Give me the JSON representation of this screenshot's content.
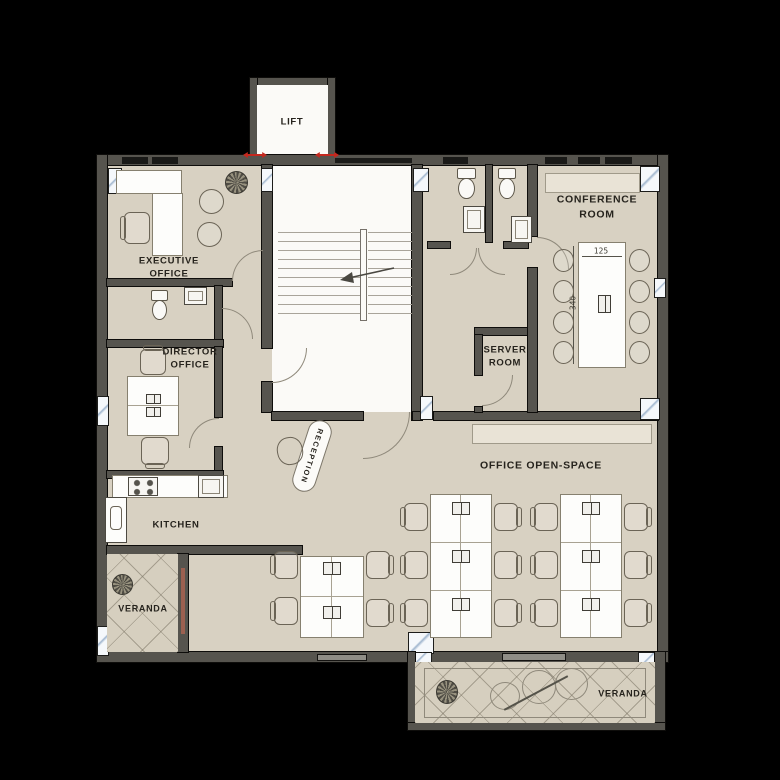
{
  "plan": {
    "rooms": {
      "lift": {
        "label": "LIFT"
      },
      "executive_office": {
        "label": "EXECUTIVE\nOFFICE"
      },
      "director_office": {
        "label": "DIRECTOR\nOFFICE"
      },
      "kitchen": {
        "label": "KITCHEN"
      },
      "veranda_left": {
        "label": "VERANDA"
      },
      "reception": {
        "label": "RECEPTION"
      },
      "server_room": {
        "label": "SERVER\nROOM"
      },
      "conference_room": {
        "label": "CONFERENCE\nROOM",
        "table_dimensions": {
          "width_cm": "125",
          "length_cm": "340"
        }
      },
      "office_open_space": {
        "label": "OFFICE OPEN-SPACE"
      },
      "veranda_right": {
        "label": "VERANDA"
      }
    },
    "colors": {
      "background": "#000000",
      "floor": "#d8d1c2",
      "wall": "#56544e",
      "stairwell_white": "#fbfaf7",
      "window_glass": "#e8eef5",
      "veranda_door_accent": "#9c6050",
      "lift_door_marker_red": "#c4281e",
      "label_text": "#26231d"
    }
  }
}
